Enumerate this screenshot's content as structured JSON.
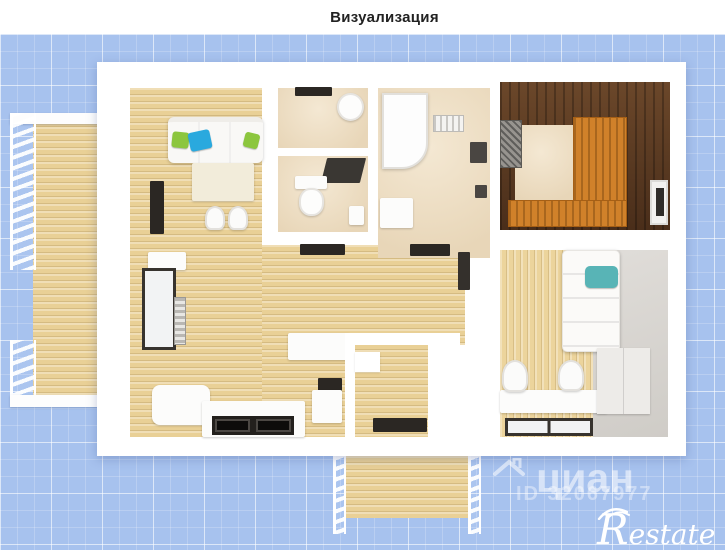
{
  "header": {
    "title": "Визуализация"
  },
  "watermarks": {
    "brand": "циан",
    "listing_id": "ID 32067977",
    "logo_text": "Restate"
  },
  "colors": {
    "blueprint_bg": "#a7c2ee",
    "wall_white": "#ffffff",
    "wood_light": "#e9d096",
    "tile_beige": "#ecdcc3",
    "sauna_wood_dark": "#573821",
    "sauna_bench_orange": "#d0812a",
    "pillow_teal": "#58b4b6",
    "pillow_green": "#8cc63e",
    "pillow_blue": "#2aa9de"
  }
}
